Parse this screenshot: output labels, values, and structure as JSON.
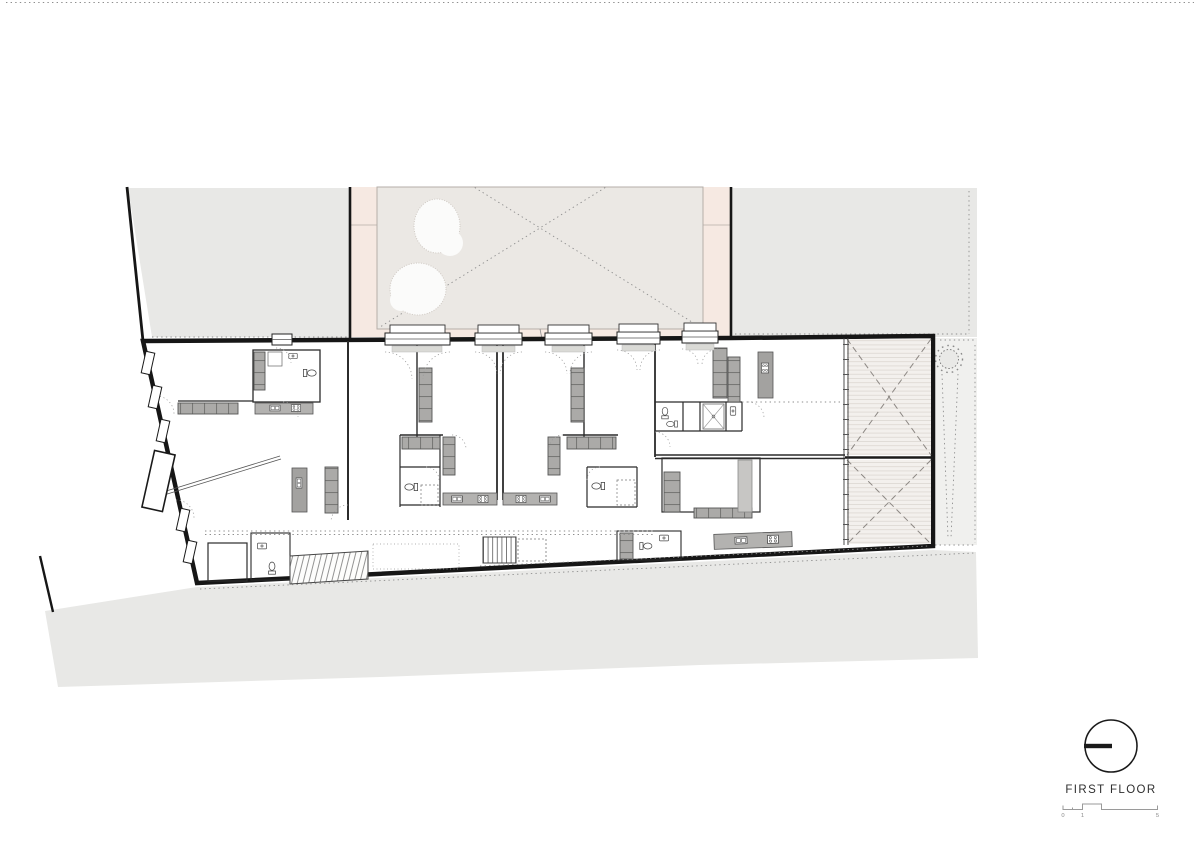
{
  "document": {
    "type": "architectural floor plan drawing",
    "floor_label": "FIRST FLOOR"
  },
  "title_block": {
    "floor_indicator_icon": "storey-indicator-circle",
    "floor_label": "FIRST FLOOR",
    "scale_bar": {
      "tick_labels": [
        "0",
        "1",
        "5"
      ]
    }
  },
  "plan_features": {
    "courtyard": "paved courtyard with two trees and dashed diagonals",
    "terraces": "two decked terraces with dashed cross bracing",
    "stairs": [
      "hatched stair lower left",
      "lined stair center corridor"
    ]
  },
  "colors": {
    "paper": "#ffffff",
    "ground": "#e8e8e6",
    "side_yard": "#f0f0ee",
    "courtyard_band": "#f6e9e2",
    "courtyard_paving": "#ebe8e4",
    "terrace_deck": "#f3f0ed",
    "wall_ink": "#1a1a1a",
    "furniture_gray": "#abaaa8",
    "label_ink": "#2e2e2e",
    "scale_ink": "#8a8a8a"
  }
}
